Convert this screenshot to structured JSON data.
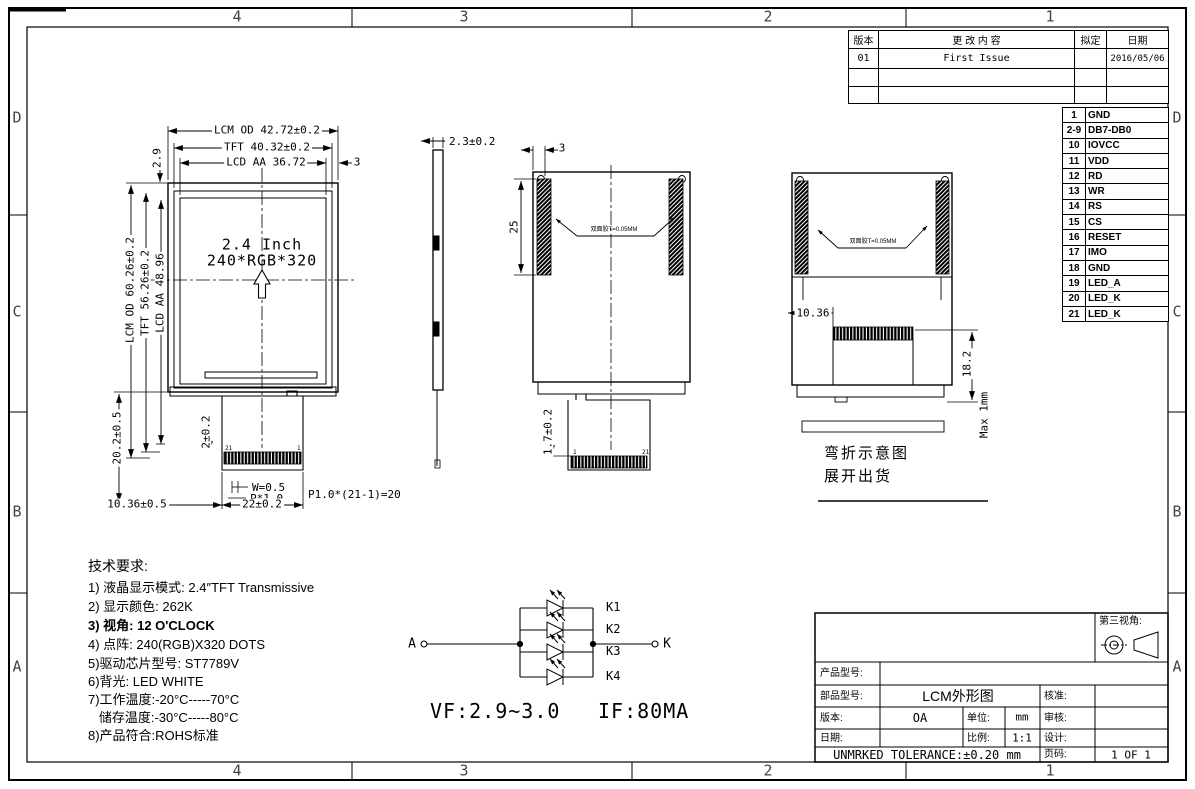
{
  "sheet": {
    "zone_cols": [
      "4",
      "3",
      "2",
      "1"
    ],
    "zone_rows": [
      "D",
      "C",
      "B",
      "A"
    ]
  },
  "revision_table": {
    "headers": {
      "rev": "版本",
      "content": "更 改 内 容",
      "drafted": "拟定",
      "date": "日期"
    },
    "rows": [
      {
        "rev": "01",
        "content": "First Issue",
        "drafted": "",
        "date": "2016/05/06"
      },
      {
        "rev": "",
        "content": "",
        "drafted": "",
        "date": ""
      },
      {
        "rev": "",
        "content": "",
        "drafted": "",
        "date": ""
      }
    ]
  },
  "pin_table": {
    "pins": [
      {
        "no": "1",
        "name": "GND"
      },
      {
        "no": "2-9",
        "name": "DB7-DB0"
      },
      {
        "no": "10",
        "name": "IOVCC"
      },
      {
        "no": "11",
        "name": "VDD"
      },
      {
        "no": "12",
        "name": "RD"
      },
      {
        "no": "13",
        "name": "WR"
      },
      {
        "no": "14",
        "name": "RS"
      },
      {
        "no": "15",
        "name": "CS"
      },
      {
        "no": "16",
        "name": "RESET"
      },
      {
        "no": "17",
        "name": "IMO"
      },
      {
        "no": "18",
        "name": "GND"
      },
      {
        "no": "19",
        "name": "LED_A"
      },
      {
        "no": "20",
        "name": "LED_K"
      },
      {
        "no": "21",
        "name": "LED_K"
      }
    ]
  },
  "front_view": {
    "screen_line1": "2.4 Inch",
    "screen_line2": "240*RGB*320",
    "dim_width_lcm": "LCM OD 42.72±0.2",
    "dim_width_tft": "TFT 40.32±0.2",
    "dim_width_lcd": "LCD AA 36.72",
    "dim_side_gap": "3",
    "dim_top_offset": "2.9",
    "dim_height_lcm": "LCM OD 60.26±0.2",
    "dim_height_tft": "TFT 56.26±0.2",
    "dim_height_lcd": "LCD AA 48.96",
    "dim_fpc_length": "20.2±0.5",
    "dim_fpc_top": "2±0.2",
    "dim_fpc_offset": "10.36±0.5",
    "dim_fpc_width": "22±0.2",
    "dim_pad_width": "W=0.5",
    "dim_pad_pitch": "P*1.0",
    "dim_pitch_total": "P1.0*(21-1)=20",
    "pin_left": "21",
    "pin_right": "1"
  },
  "side_view": {
    "dim_thickness": "2.3±0.2"
  },
  "back_view": {
    "dim_tape_edge": "3",
    "dim_tape_length": "25",
    "tape_label": "双面胶T=0.05MM",
    "dim_fpc": "1.7±0.2",
    "pin_left": "1",
    "pin_right": "21"
  },
  "bend_view": {
    "tape_label": "双面胶T=0.05MM",
    "dim_offset": "10.36",
    "dim_length": "18.2",
    "dim_max": "Max 1mm",
    "caption_line1": "弯折示意图",
    "caption_line2": "展开出货"
  },
  "tech_notes": {
    "title": "技术要求:",
    "lines": [
      "1) 液晶显示模式: 2.4″TFT Transmissive",
      "2) 显示颜色: 262K",
      "3) 视角: 12 O'CLOCK",
      "4) 点阵: 240(RGB)X320 DOTS",
      "5)驱动芯片型号: ST7789V",
      "6)背光: LED WHITE",
      "7)工作温度:-20°C-----70°C",
      "   储存温度:-30°C-----80°C",
      "8)产品符合:ROHS标准"
    ]
  },
  "led_circuit": {
    "anode": "A",
    "cathode": "K",
    "branches": [
      "K1",
      "K2",
      "K3",
      "K4"
    ],
    "vf": "VF:2.9~3.0",
    "if": "IF:80MA"
  },
  "title_block": {
    "third_angle_label": "第三视角:",
    "product_model_label": "产品型号:",
    "part_model_label": "部品型号:",
    "part_model_value": "LCM外形图",
    "approve_label": "核准:",
    "version_label": "版本:",
    "version_value": "OA",
    "unit_label": "单位:",
    "unit_value": "mm",
    "review_label": "审核:",
    "date_label": "日期:",
    "scale_label": "比例:",
    "scale_value": "1:1",
    "design_label": "设计:",
    "tolerance": "UNMRKED TOLERANCE:±0.20 mm",
    "page_label": "页码:",
    "page_value": "1 OF 1"
  }
}
